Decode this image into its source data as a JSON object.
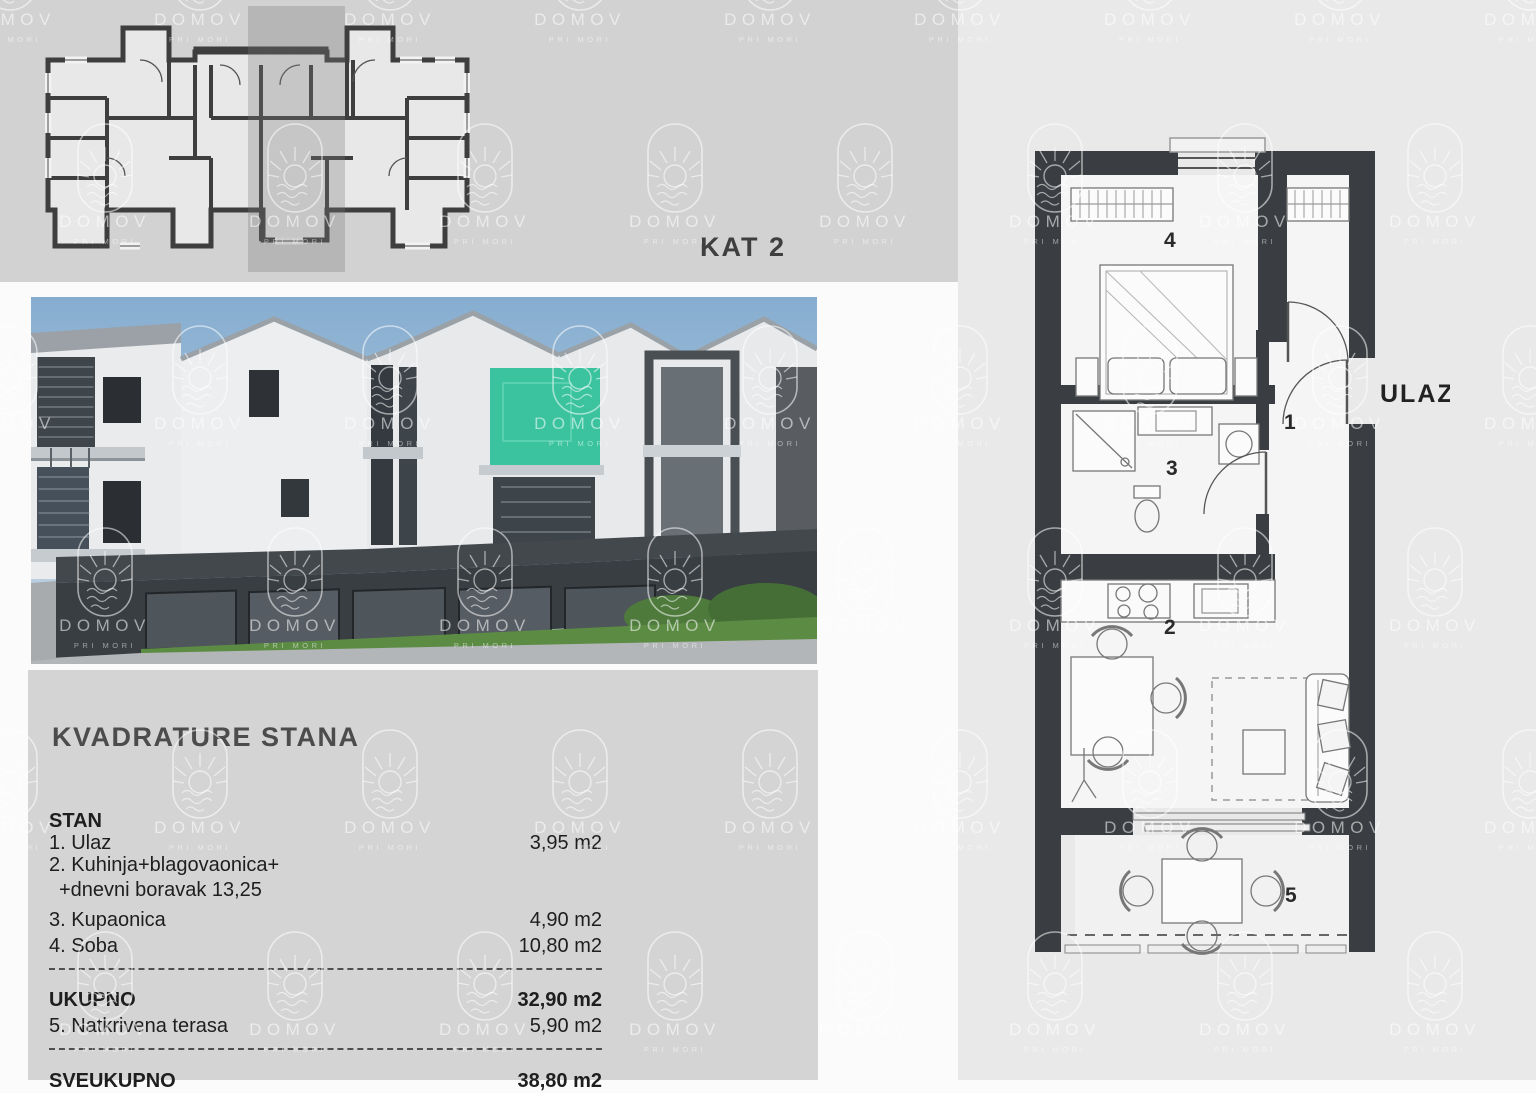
{
  "header": {
    "floor_label": "KAT 2"
  },
  "watermark": {
    "brand": "DOMOV",
    "sub": "PRI MORI"
  },
  "right_plan": {
    "entrance_label": "ULAZ",
    "room_labels": [
      "1",
      "2",
      "3",
      "4",
      "5"
    ]
  },
  "summary": {
    "title": "KVADRATURE STANA",
    "lines": [
      {
        "label": "STAN",
        "value": ""
      },
      {
        "label": "1. Ulaz",
        "value": "3,95 m2"
      },
      {
        "label": "2. Kuhinja+blagovaonica+",
        "value": ""
      },
      {
        "label": "+dnevni boravak 13,25",
        "value": ""
      },
      {
        "label": "3. Kupaonica",
        "value": "4,90 m2"
      },
      {
        "label": "4. Soba",
        "value": "10,80 m2"
      },
      {
        "label": "UKUPNO",
        "value": "32,90 m2"
      },
      {
        "label": "5. Natkrivena terasa",
        "value": "5,90 m2"
      },
      {
        "label": "SVEUKUPNO",
        "value": "38,80 m2"
      }
    ]
  },
  "colors": {
    "band": "#d2d2d2",
    "panel": "#d4d4d4",
    "right_panel": "#e9e9e9",
    "wall": "#3a3e42",
    "highlight_unit": "#2dbf99",
    "grass": "#5c8c44",
    "sky": "#86add0"
  }
}
